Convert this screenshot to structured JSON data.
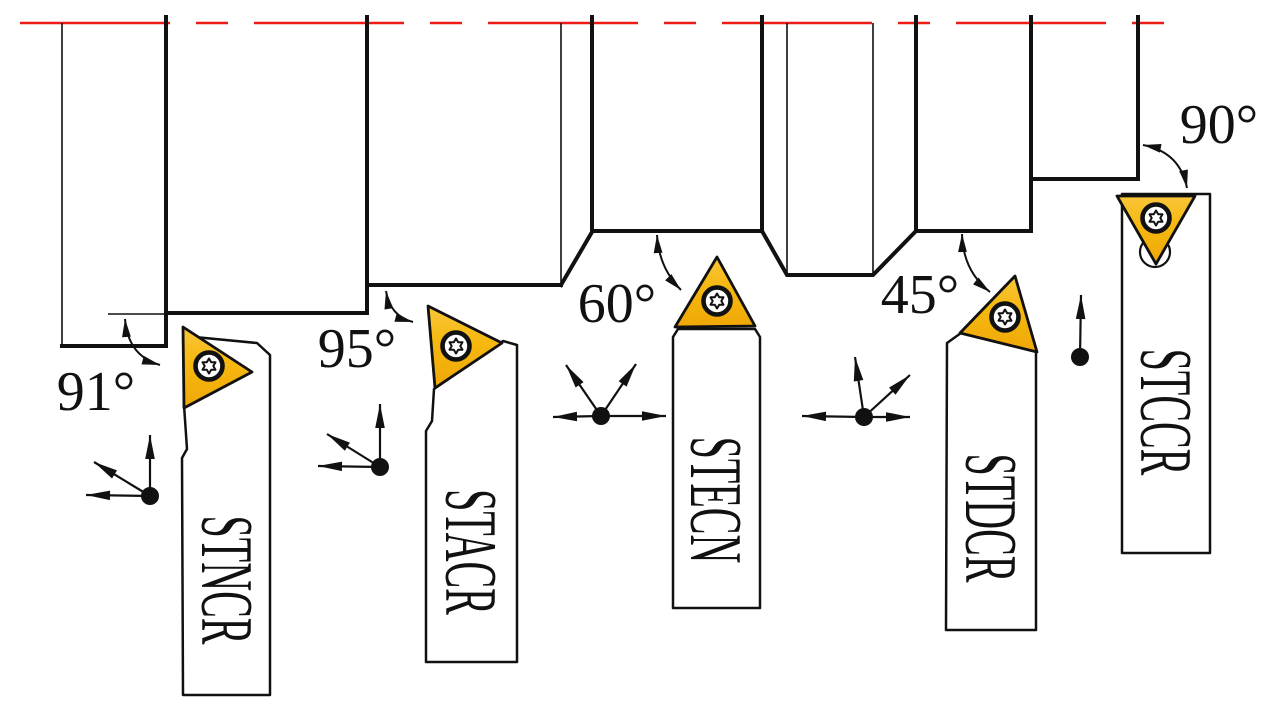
{
  "drawing": {
    "kind": "engineering-diagram",
    "subject": "External turning tool holders with approach angles against a stepped shaft profile",
    "colors": {
      "centerline_red": "#ee1b17",
      "insert_gold": "#f6b80f",
      "outline_black": "#111111",
      "background": "#ffffff"
    },
    "tools": [
      {
        "name": "STNCR",
        "angle_label": "91°",
        "feed_directions": [
          "left",
          "up",
          "up-left"
        ]
      },
      {
        "name": "STACR",
        "angle_label": "95°",
        "feed_directions": [
          "left",
          "up",
          "up-left"
        ]
      },
      {
        "name": "STECN",
        "angle_label": "60°",
        "feed_directions": [
          "left",
          "right",
          "up-left",
          "up-right"
        ]
      },
      {
        "name": "STDCR",
        "angle_label": "45°",
        "feed_directions": [
          "left",
          "right",
          "up",
          "up-right"
        ]
      },
      {
        "name": "STCCR",
        "angle_label": "90°",
        "feed_directions": [
          "up"
        ]
      }
    ]
  }
}
